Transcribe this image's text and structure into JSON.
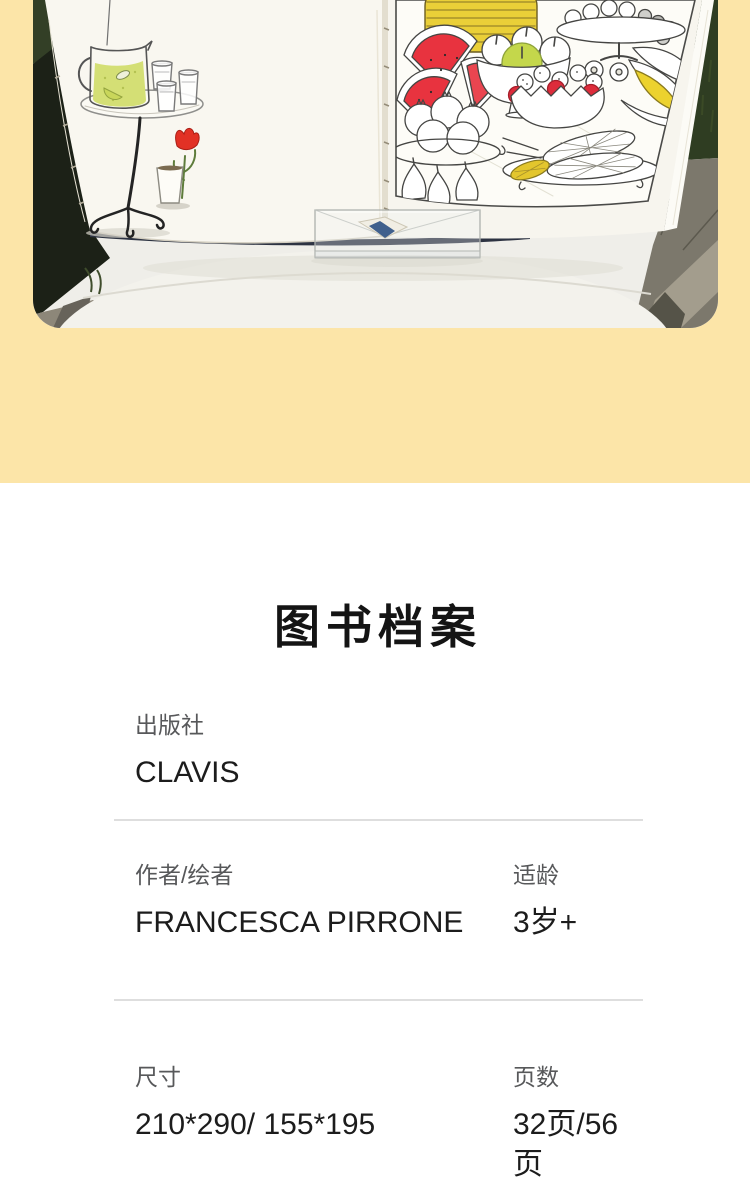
{
  "section": {
    "title": "图书档案"
  },
  "info": {
    "rows": [
      {
        "fields": [
          {
            "label": "出版社",
            "value": "CLAVIS"
          }
        ]
      },
      {
        "fields": [
          {
            "label": "作者/绘者",
            "value": "FRANCESCA PIRRONE"
          },
          {
            "label": "适龄",
            "value": "3岁+"
          }
        ]
      },
      {
        "fields": [
          {
            "label": "尺寸",
            "value": "210*290/ 155*195"
          },
          {
            "label": "页数",
            "value": "32页/56页"
          }
        ]
      }
    ]
  },
  "colors": {
    "background_yellow": "#fce5a8",
    "section_background": "#ffffff",
    "label_gray": "#57585a",
    "value_dark": "#1c1c1c",
    "divider_gray": "#dedede",
    "illustration_red": "#e8333f",
    "illustration_green": "#c4d74b",
    "illustration_yellow": "#eacf38"
  }
}
